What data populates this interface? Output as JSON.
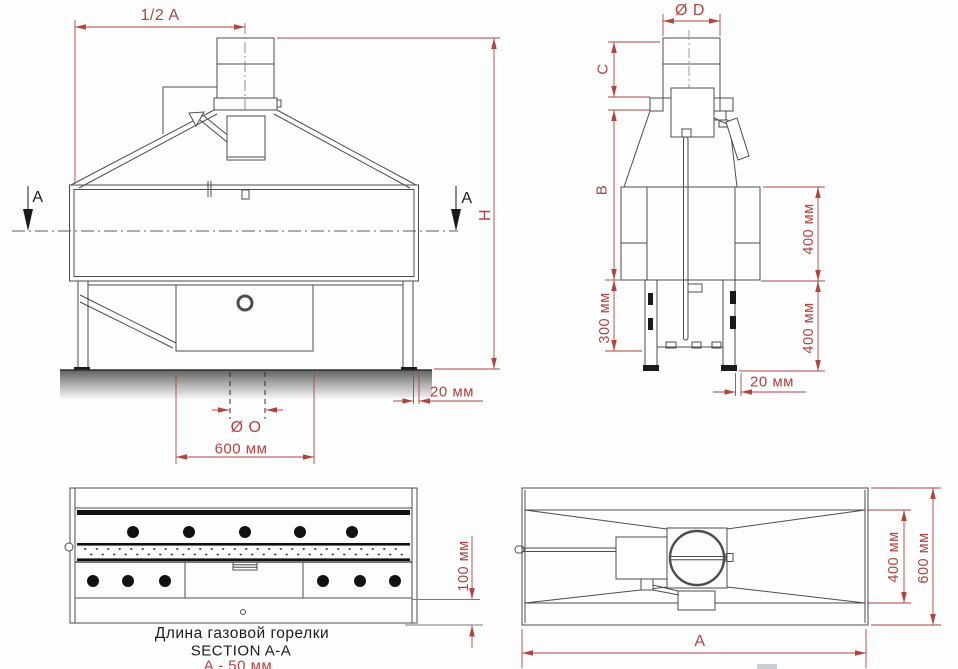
{
  "drawing": {
    "type": "technical drawing, gas grill / barbecue oven, 4 orthographic views"
  },
  "front_view": {
    "dim_half_a": "1/2 A",
    "dim_height": "H",
    "dim_offset": "20 мм",
    "dim_flue_hole": "Ø O",
    "dim_width_600": "600 мм",
    "section_marker_left": "A",
    "section_marker_right": "A"
  },
  "side_view": {
    "dim_flue_diameter": "Ø D",
    "dim_chimney_height": "C",
    "dim_hood_height": "B",
    "dim_legs_300": "300 мм",
    "dim_body_400": "400 мм",
    "dim_legs_400": "400 мм",
    "dim_offset": "20 мм"
  },
  "section_view": {
    "dim_100": "100 мм",
    "caption_burner": "Длина газовой горелки",
    "caption_section": "SECTION A-A",
    "caption_formula": "A - 50 мм"
  },
  "top_view": {
    "dim_inner_400": "400 мм",
    "dim_outer_600": "600 мм",
    "dim_length": "A"
  },
  "colors": {
    "dimension_red": "#b0443e",
    "line_dark": "#4d4d4d",
    "fill_black": "#1a1a1a"
  }
}
